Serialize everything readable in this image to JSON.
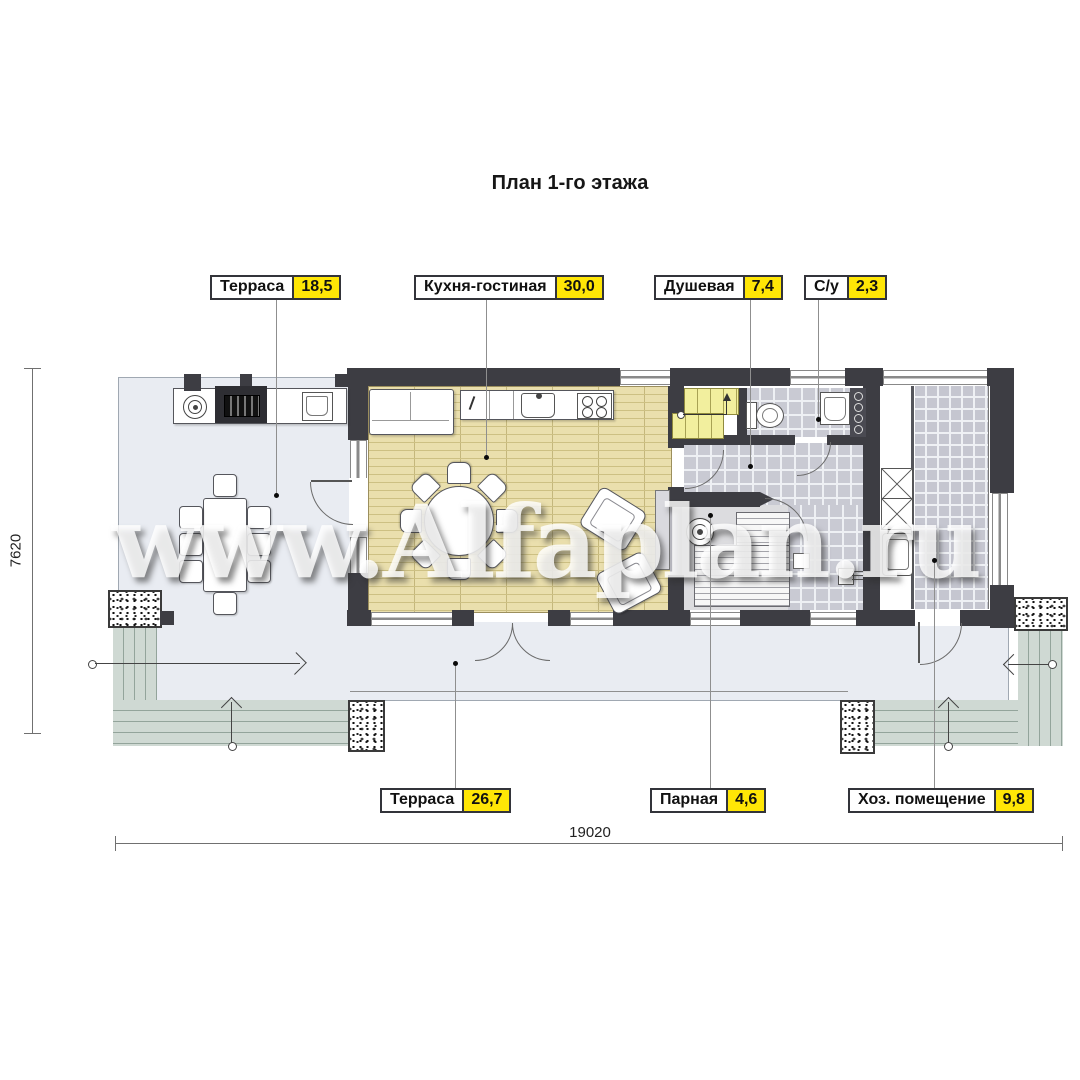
{
  "title": "План 1-го этажа",
  "watermark": "www.Alfaplan.ru",
  "labels": {
    "top": [
      {
        "name": "Терраса",
        "area": "18,5"
      },
      {
        "name": "Кухня-гостиная",
        "area": "30,0"
      },
      {
        "name": "Душевая",
        "area": "7,4"
      },
      {
        "name": "С/у",
        "area": "2,3"
      }
    ],
    "bottom": [
      {
        "name": "Терраса",
        "area": "26,7"
      },
      {
        "name": "Парная",
        "area": "4,6"
      },
      {
        "name": "Хоз. помещение",
        "area": "9,8"
      }
    ]
  },
  "dimensions": {
    "horizontal": "19020",
    "vertical": "7620"
  },
  "colors": {
    "wall": "#3d3d43",
    "badge": "#ffe606",
    "living_floor": "#eadfad",
    "tile_floor": "#c9cad3",
    "terrace": "#e9ecf2",
    "steps": "#cfd9d3",
    "stairs": "#f2ef9e"
  }
}
